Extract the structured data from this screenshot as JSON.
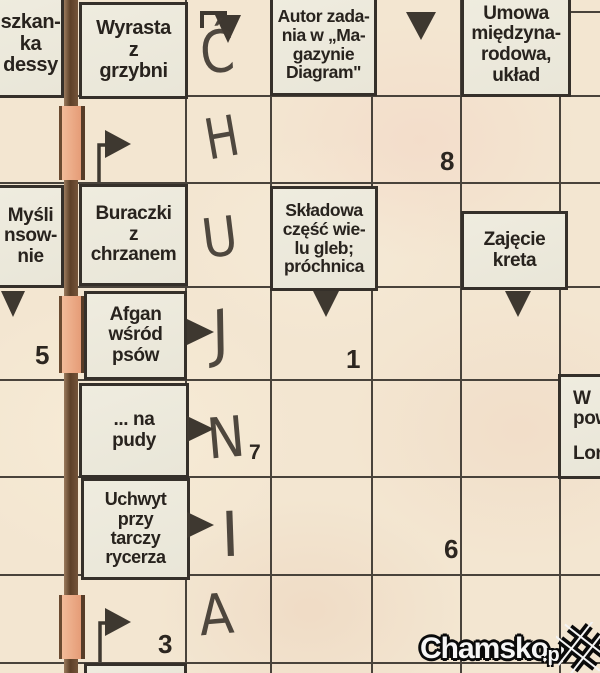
{
  "page": {
    "kind": "scanned newspaper crossword",
    "language": "Polish"
  },
  "letters": [
    "Ć",
    "H",
    "U",
    "J",
    "N",
    "I",
    "A"
  ],
  "cell_numbers": [
    "8",
    "5",
    "1",
    "7",
    "6",
    "3"
  ],
  "clues": {
    "top_left_partial": {
      "lines": [
        "szkan-",
        "ka",
        "dessy"
      ]
    },
    "wyrasta": {
      "lines": [
        "Wyrasta",
        "z",
        "grzybni"
      ]
    },
    "autor": {
      "lines": [
        "Autor zada-",
        "nia w „Ma-",
        "gazynie",
        "Diagram\""
      ]
    },
    "umowa": {
      "lines": [
        "Umowa",
        "międzyna-",
        "rodowa,",
        "układ"
      ]
    },
    "mysli_partial": {
      "lines": [
        "Myśli",
        "nsow-",
        "nie"
      ]
    },
    "buraczki": {
      "lines": [
        "Buraczki",
        "z",
        "chrzanem"
      ]
    },
    "skladowa": {
      "lines": [
        "Składowa",
        "część wie-",
        "lu gleb;",
        "próchnica"
      ]
    },
    "zajecie": {
      "lines": [
        "Zajęcie",
        "kreta"
      ]
    },
    "afgan": {
      "lines": [
        "Afgan",
        "wśród",
        "psów"
      ]
    },
    "na_pudy": {
      "lines": [
        "... na",
        "pudy"
      ]
    },
    "uchwyt": {
      "lines": [
        "Uchwyt",
        "przy",
        "tarczy",
        "rycerza"
      ]
    },
    "w_pow_partial": {
      "lines": [
        "W",
        "pow"
      ]
    },
    "lon_partial": {
      "lines": [
        "Lon"
      ]
    }
  },
  "watermark": {
    "brand": "Chamsko",
    "tld": ".pl"
  },
  "icons": {
    "down_arrow": "solid triangle pointing down",
    "right_arrow": "solid triangle pointing right",
    "bent_down_arrow": "elbow line ending in down triangle",
    "flag_arrow": "right pennant with down stem",
    "watermark_hash": "pixelated rotated hash mark"
  },
  "colors": {
    "paper": "#f3e6d1",
    "clue_box": "#ece9dc",
    "grid_line": "#49433b",
    "clue_text": "#28231e",
    "handwriting": "#423b33",
    "fold_salmon": "#eba988",
    "fold_brown": "#6a4a30",
    "watermark_fill": "#f6f6f6",
    "watermark_outline": "#0a0a0a"
  }
}
